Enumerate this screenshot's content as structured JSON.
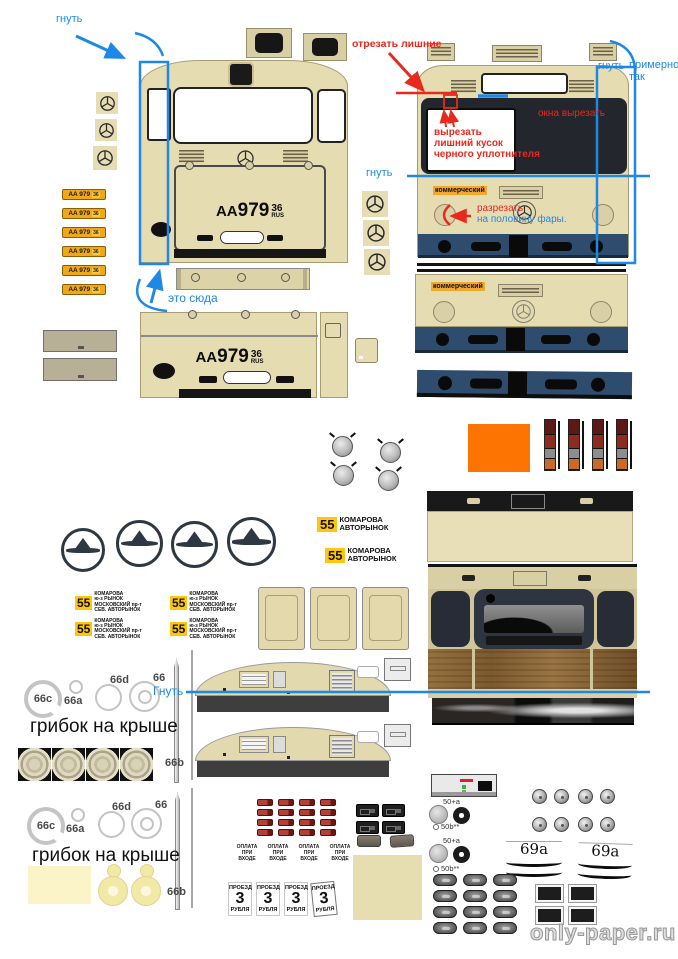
{
  "palette": {
    "body_beige": "#e6dcb2",
    "navy_bumper": "#2e4c6d",
    "window_black": "#23262c",
    "annotation_blue": "#1e88e5",
    "annotation_red": "#e8291c",
    "plate_yellow": "#f0a818",
    "route_sign_yellow": "#ffc60b",
    "orange_part": "#fd7402",
    "wood_brown": "#8a6134",
    "pale_yellow": "#faf4c8"
  },
  "annotations": {
    "bend_top_left": "гнуть",
    "this_goes_here": "это сюда",
    "cut_off_excess": "отрезать лишние",
    "cut_out_windows": "окна вырезать",
    "cut_out_seal": "вырезать\nлишний кусок\nчерного уплотнителя",
    "bend_front_line": "гнуть",
    "bend_top_right": "гнуть",
    "approximately_so": "примерно\nтак",
    "cut_headlight_1": "разрезать",
    "cut_headlight_2": "на половину фары.",
    "bend_roof_line": "Гнуть",
    "mushroom_on_roof_1": "грибок на крыше",
    "mushroom_on_roof_2": "грибок на крыше"
  },
  "bus": {
    "commercial_label": "коммерческий",
    "plate_letters": "AA",
    "plate_digits": "979",
    "plate_region": "36",
    "plate_country": "RUS",
    "small_plate_text": "AA 979",
    "small_plate_region": "36"
  },
  "route_signs": {
    "big": {
      "number": "55",
      "line1": "КОМАРОВА",
      "line2": "АВТОРЫНОК"
    },
    "small": {
      "number": "55",
      "text": "КОМАРОВА\nю-з РЫНОК\nМОСКОВСКИЙ пр-т\nСЕВ. АВТОРЫНОК"
    }
  },
  "interior_signs": {
    "payment": "ОПЛАТА\nПРИ\nВХОДЕ",
    "fare_top": "ПРОЕЗД",
    "fare_number": "3",
    "fare_bottom": "РУБЛЯ"
  },
  "part_labels": {
    "l66c": "66c",
    "l66a": "66a",
    "l66d": "66d",
    "l66": "66",
    "l66b": "66b",
    "l50a": "50+a",
    "l50b": "50b**",
    "l69a": "69a"
  },
  "watermark": "only-paper.ru"
}
